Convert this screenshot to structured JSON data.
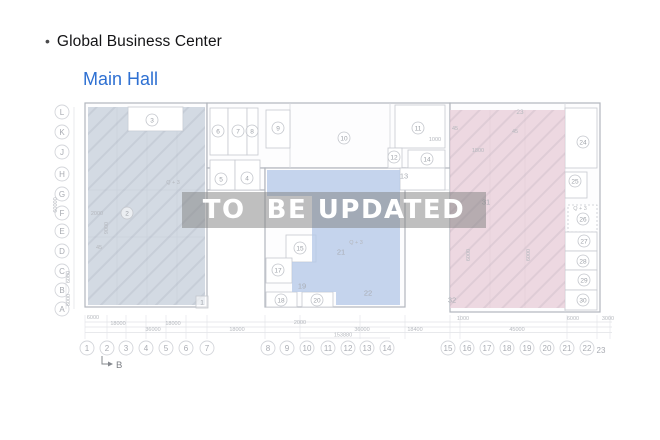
{
  "header": {
    "bullet": "•",
    "title": "Global Business Center"
  },
  "subheader": {
    "title": "Main Hall"
  },
  "watermark": {
    "text": "TO  BE UPDATED"
  },
  "colors": {
    "accent_blue": "#2e70d2",
    "zone_left": "#c8d1dc",
    "zone_middle": "#b7c9e8",
    "zone_right": "#e8ced9",
    "wall": "#b2b6bd",
    "line_light": "#d5d8dd",
    "label": "#9da1a8",
    "dim": "#b6b9bf"
  },
  "plan": {
    "walls": [
      {
        "x": 85,
        "y": 103,
        "w": 122,
        "h": 204
      },
      {
        "x": 207,
        "y": 103,
        "w": 243,
        "h": 65
      },
      {
        "x": 207,
        "y": 168,
        "w": 58,
        "h": 22
      },
      {
        "x": 265,
        "y": 168,
        "w": 140,
        "h": 139
      },
      {
        "x": 450,
        "y": 103,
        "w": 150,
        "h": 209
      }
    ],
    "boxes": [
      {
        "x": 128,
        "y": 107,
        "w": 55,
        "h": 24
      },
      {
        "x": 210,
        "y": 108,
        "w": 18,
        "h": 47
      },
      {
        "x": 228,
        "y": 108,
        "w": 19,
        "h": 47
      },
      {
        "x": 247,
        "y": 108,
        "w": 11,
        "h": 47
      },
      {
        "x": 210,
        "y": 160,
        "w": 25,
        "h": 30
      },
      {
        "x": 235,
        "y": 160,
        "w": 25,
        "h": 30
      },
      {
        "x": 266,
        "y": 110,
        "w": 24,
        "h": 38
      },
      {
        "x": 395,
        "y": 105,
        "w": 50,
        "h": 43
      },
      {
        "x": 388,
        "y": 148,
        "w": 14,
        "h": 20
      },
      {
        "x": 408,
        "y": 150,
        "w": 37,
        "h": 18
      },
      {
        "x": 400,
        "y": 168,
        "w": 45,
        "h": 22
      },
      {
        "x": 286,
        "y": 235,
        "w": 30,
        "h": 27
      },
      {
        "x": 266,
        "y": 258,
        "w": 26,
        "h": 25
      },
      {
        "x": 266,
        "y": 292,
        "w": 31,
        "h": 15
      },
      {
        "x": 302,
        "y": 292,
        "w": 31,
        "h": 15
      },
      {
        "x": 565,
        "y": 108,
        "w": 32,
        "h": 60
      },
      {
        "x": 565,
        "y": 172,
        "w": 22,
        "h": 26
      },
      {
        "x": 568,
        "y": 205,
        "w": 29,
        "h": 27,
        "dash": true
      },
      {
        "x": 565,
        "y": 232,
        "w": 32,
        "h": 19
      },
      {
        "x": 565,
        "y": 251,
        "w": 32,
        "h": 19
      },
      {
        "x": 565,
        "y": 270,
        "w": 32,
        "h": 20
      },
      {
        "x": 565,
        "y": 290,
        "w": 32,
        "h": 20
      }
    ],
    "lines": [
      {
        "x1": 117,
        "y1": 107,
        "x2": 117,
        "y2": 305
      },
      {
        "x1": 147,
        "y1": 107,
        "x2": 147,
        "y2": 305
      },
      {
        "x1": 177,
        "y1": 107,
        "x2": 177,
        "y2": 305
      },
      {
        "x1": 88,
        "y1": 190,
        "x2": 205,
        "y2": 190
      },
      {
        "x1": 88,
        "y1": 237,
        "x2": 205,
        "y2": 237
      },
      {
        "x1": 290,
        "y1": 103,
        "x2": 290,
        "y2": 168
      },
      {
        "x1": 390,
        "y1": 103,
        "x2": 390,
        "y2": 168
      },
      {
        "x1": 405,
        "y1": 190,
        "x2": 450,
        "y2": 190
      },
      {
        "x1": 565,
        "y1": 103,
        "x2": 565,
        "y2": 312
      },
      {
        "x1": 490,
        "y1": 110,
        "x2": 490,
        "y2": 308
      },
      {
        "x1": 525,
        "y1": 110,
        "x2": 525,
        "y2": 308
      }
    ],
    "zones": [
      {
        "id": "left-hall",
        "path": "M88 107 H128 V131 H183 V107 H205 V305 H88 Z",
        "color_key": "zone_left",
        "hatch": true
      },
      {
        "id": "middle-hall",
        "path": "M267 170 H400 V305 H336 V292 H292 V262 H312 V196 H267 Z",
        "color_key": "zone_middle",
        "hatch": false
      },
      {
        "id": "right-hall",
        "path": "M450 110 H565 V308 H450 Z",
        "color_key": "zone_right",
        "hatch": true
      }
    ],
    "rooms": [
      {
        "n": "1",
        "x": 202,
        "y": 302,
        "style": "box"
      },
      {
        "n": "2",
        "x": 127,
        "y": 213,
        "style": "circle"
      },
      {
        "n": "3",
        "x": 152,
        "y": 120,
        "style": "circle"
      },
      {
        "n": "4",
        "x": 247,
        "y": 178,
        "style": "circle"
      },
      {
        "n": "5",
        "x": 221,
        "y": 179,
        "style": "circle"
      },
      {
        "n": "6",
        "x": 218,
        "y": 131,
        "style": "circle"
      },
      {
        "n": "7",
        "x": 238,
        "y": 131,
        "style": "circle"
      },
      {
        "n": "8",
        "x": 252,
        "y": 131,
        "style": "circle"
      },
      {
        "n": "9",
        "x": 278,
        "y": 128,
        "style": "circle"
      },
      {
        "n": "10",
        "x": 344,
        "y": 138,
        "style": "circle"
      },
      {
        "n": "11",
        "x": 418,
        "y": 128,
        "style": "circle"
      },
      {
        "n": "12",
        "x": 394,
        "y": 157,
        "style": "circle"
      },
      {
        "n": "13",
        "x": 404,
        "y": 176,
        "style": "plain"
      },
      {
        "n": "14",
        "x": 427,
        "y": 159,
        "style": "circle"
      },
      {
        "n": "15",
        "x": 300,
        "y": 248,
        "style": "circle"
      },
      {
        "n": "17",
        "x": 278,
        "y": 270,
        "style": "circle"
      },
      {
        "n": "18",
        "x": 281,
        "y": 300,
        "style": "circle"
      },
      {
        "n": "19",
        "x": 302,
        "y": 286,
        "style": "plain"
      },
      {
        "n": "20",
        "x": 317,
        "y": 300,
        "style": "circle"
      },
      {
        "n": "21",
        "x": 341,
        "y": 252,
        "style": "plain"
      },
      {
        "n": "22",
        "x": 368,
        "y": 293,
        "style": "plain"
      },
      {
        "n": "24",
        "x": 583,
        "y": 142,
        "style": "circle"
      },
      {
        "n": "25",
        "x": 575,
        "y": 181,
        "style": "circle"
      },
      {
        "n": "26",
        "x": 583,
        "y": 219,
        "style": "circle"
      },
      {
        "n": "27",
        "x": 584,
        "y": 241,
        "style": "circle"
      },
      {
        "n": "28",
        "x": 583,
        "y": 261,
        "style": "circle"
      },
      {
        "n": "29",
        "x": 584,
        "y": 280,
        "style": "circle"
      },
      {
        "n": "30",
        "x": 583,
        "y": 300,
        "style": "circle"
      },
      {
        "n": "31",
        "x": 486,
        "y": 202,
        "style": "plain"
      },
      {
        "n": "32",
        "x": 452,
        "y": 300,
        "style": "plain"
      }
    ],
    "row_axis": {
      "x": 62,
      "items": [
        {
          "t": "L",
          "y": 112
        },
        {
          "t": "K",
          "y": 132
        },
        {
          "t": "J",
          "y": 152
        },
        {
          "t": "H",
          "y": 174
        },
        {
          "t": "G",
          "y": 194
        },
        {
          "t": "F",
          "y": 213
        },
        {
          "t": "E",
          "y": 231
        },
        {
          "t": "D",
          "y": 251
        },
        {
          "t": "C",
          "y": 271
        },
        {
          "t": "B",
          "y": 290
        },
        {
          "t": "A",
          "y": 309
        }
      ]
    },
    "col_axis": {
      "y": 348,
      "items": [
        {
          "t": "1",
          "x": 87
        },
        {
          "t": "2",
          "x": 107
        },
        {
          "t": "3",
          "x": 126
        },
        {
          "t": "4",
          "x": 146
        },
        {
          "t": "5",
          "x": 166
        },
        {
          "t": "6",
          "x": 186
        },
        {
          "t": "7",
          "x": 207
        },
        {
          "t": "8",
          "x": 268
        },
        {
          "t": "9",
          "x": 287
        },
        {
          "t": "10",
          "x": 307
        },
        {
          "t": "11",
          "x": 328
        },
        {
          "t": "12",
          "x": 348
        },
        {
          "t": "13",
          "x": 367
        },
        {
          "t": "14",
          "x": 387
        },
        {
          "t": "15",
          "x": 448
        },
        {
          "t": "16",
          "x": 467
        },
        {
          "t": "17",
          "x": 487
        },
        {
          "t": "18",
          "x": 507
        },
        {
          "t": "19",
          "x": 527
        },
        {
          "t": "20",
          "x": 547
        },
        {
          "t": "21",
          "x": 567
        },
        {
          "t": "22",
          "x": 587
        }
      ],
      "extra": {
        "t": "23",
        "x": 601,
        "y": 353
      }
    },
    "dim_lines": [
      {
        "x1": 85,
        "y1": 322,
        "x2": 612,
        "y2": 322
      },
      {
        "x1": 85,
        "y1": 327,
        "x2": 612,
        "y2": 327
      },
      {
        "x1": 85,
        "y1": 332.5,
        "x2": 612,
        "y2": 332.5
      },
      {
        "x1": 300,
        "y1": 338,
        "x2": 390,
        "y2": 338
      },
      {
        "x1": 74,
        "y1": 107,
        "x2": 74,
        "y2": 309
      },
      {
        "x1": 66,
        "y1": 271,
        "x2": 66,
        "y2": 309
      }
    ],
    "ticks": [
      85,
      107,
      126,
      146,
      166,
      186,
      207,
      265,
      300,
      360,
      405,
      450,
      460,
      567,
      597,
      610
    ],
    "dims": [
      {
        "t": "6000",
        "x": 93,
        "y": 319
      },
      {
        "t": "2000",
        "x": 300,
        "y": 324
      },
      {
        "t": "1000",
        "x": 463,
        "y": 320
      },
      {
        "t": "6000",
        "x": 573,
        "y": 320
      },
      {
        "t": "3000",
        "x": 608,
        "y": 320
      },
      {
        "t": "18000",
        "x": 118,
        "y": 325
      },
      {
        "t": "18000",
        "x": 173,
        "y": 325
      },
      {
        "t": "36000",
        "x": 153,
        "y": 331
      },
      {
        "t": "18000",
        "x": 237,
        "y": 331
      },
      {
        "t": "36000",
        "x": 362,
        "y": 331
      },
      {
        "t": "18400",
        "x": 415,
        "y": 331
      },
      {
        "t": "45000",
        "x": 517,
        "y": 331
      },
      {
        "t": "153880",
        "x": 343,
        "y": 336.5
      }
    ],
    "vdims": [
      {
        "t": "60000",
        "x": 57,
        "y": 205
      },
      {
        "t": "9000",
        "x": 108,
        "y": 228
      },
      {
        "t": "6000",
        "x": 70,
        "y": 277
      },
      {
        "t": "6000",
        "x": 70,
        "y": 300
      },
      {
        "t": "6000",
        "x": 470,
        "y": 255
      },
      {
        "t": "6000",
        "x": 530,
        "y": 255
      }
    ],
    "annotations": [
      {
        "t": "Q + 3",
        "x": 173,
        "y": 184
      },
      {
        "t": "Q + 3",
        "x": 356,
        "y": 244
      },
      {
        "t": "Q + 3",
        "x": 580,
        "y": 210
      },
      {
        "t": "23",
        "x": 520,
        "y": 114,
        "s": 6.5
      },
      {
        "t": "1000",
        "x": 435,
        "y": 141
      },
      {
        "t": "1800",
        "x": 478,
        "y": 152
      },
      {
        "t": "2000",
        "x": 97,
        "y": 215
      },
      {
        "t": "45",
        "x": 99,
        "y": 249
      },
      {
        "t": "45",
        "x": 455,
        "y": 130
      },
      {
        "t": "45",
        "x": 515,
        "y": 133
      }
    ],
    "b_marker": {
      "label": "B"
    }
  }
}
